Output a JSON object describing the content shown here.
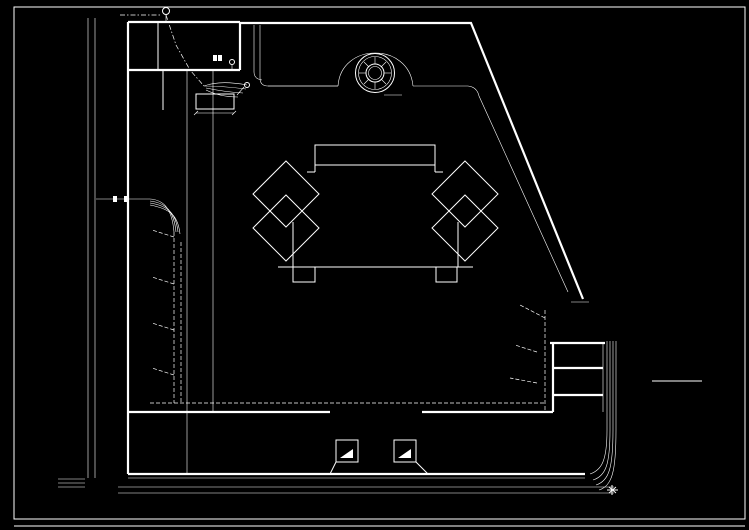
{
  "meta": {
    "bg": "#000000",
    "fg": "#ffffff"
  },
  "labels": {
    "plan_title": "电气总平面图",
    "gate": "大门",
    "fountain": "喷泉",
    "red_line": "红线",
    "top_marker": "T1"
  },
  "legend": {
    "title": "主要电气设备图例表",
    "rows": [
      [
        "单管荧光灯",
        "—⊷",
        "照明配电箱",
        "▭"
      ],
      [
        "双管荧光灯",
        "⊶⊶",
        "动力配电箱",
        "▦"
      ],
      [
        "防水防尘灯",
        "⊗",
        "电度表箱",
        "◫"
      ],
      [
        "吸顶灯",
        "⊕",
        "单相插座",
        "⏚"
      ],
      [
        "壁灯",
        "◑",
        "空调插座",
        "⌇"
      ],
      [
        "疏散指示灯",
        "▣",
        "单联暗开关",
        "↾"
      ],
      [
        "安全出口灯",
        "▤",
        "双联暗开关",
        "⇂"
      ],
      [
        "庭院灯",
        "⍟",
        "电话出线口",
        "TP"
      ],
      [
        "草坪灯",
        "⊙",
        "电视出线口",
        "TV"
      ],
      [
        "路灯",
        "⍉",
        "接地装置",
        "≡"
      ]
    ]
  },
  "title_block": {
    "project": "某住宅小区",
    "scale_label": "比例",
    "scale": "1:500",
    "drawing": "电气总平面图",
    "fields": [
      "设计",
      "制图",
      "校对",
      "审核"
    ],
    "sheet_label": "图别",
    "sheet": "电施",
    "no_label": "图号",
    "no": "01"
  },
  "axes": {
    "left_y": [
      22,
      43,
      65,
      88,
      111,
      133,
      155,
      177,
      201,
      217,
      240,
      264,
      287,
      310,
      332,
      355,
      377,
      400,
      414,
      445,
      473
    ],
    "bottom_x": [
      126,
      150,
      175,
      200,
      225,
      250,
      275,
      300,
      325,
      340,
      357,
      395,
      413,
      428,
      451,
      477,
      503,
      522,
      551,
      578,
      604
    ],
    "left_numbers": [
      "1",
      "2",
      "3",
      "4",
      "5",
      "6",
      "7",
      "8",
      "9",
      "10",
      "11",
      "12",
      "13",
      "14",
      "15",
      "16",
      "17",
      "18",
      "19",
      "20",
      "21"
    ],
    "bottom_numbers": [
      "1",
      "2",
      "3",
      "4",
      "5",
      "6",
      "7",
      "8",
      "9",
      "10",
      "11",
      "12",
      "13",
      "14",
      "15",
      "16",
      "17",
      "18",
      "19",
      "20",
      "21"
    ],
    "dim_left": "3600",
    "dim_bottom": "3300",
    "dim_gap": "7200",
    "dim_pump": "6000"
  },
  "walls": {
    "left_floor_thick": [
      88,
      111,
      133,
      155,
      177,
      201,
      217,
      262,
      310,
      355,
      397
    ],
    "left_floor_thin": [
      240,
      284,
      330,
      375
    ],
    "bottom_wall_x": [
      150,
      175,
      200,
      225,
      250,
      275,
      300,
      325,
      330,
      422,
      428,
      451,
      477,
      503,
      526,
      551,
      583
    ]
  },
  "routes": {
    "junctions": [
      [
        174,
        237
      ],
      [
        181,
        242
      ],
      [
        174,
        284
      ],
      [
        181,
        289
      ],
      [
        174,
        330
      ],
      [
        181,
        335
      ],
      [
        174,
        375
      ],
      [
        181,
        380
      ],
      [
        193,
        403
      ],
      [
        246,
        403
      ],
      [
        298,
        403
      ],
      [
        438,
        403
      ],
      [
        490,
        403
      ],
      [
        543,
        318
      ],
      [
        549,
        325
      ],
      [
        537,
        352
      ],
      [
        543,
        359
      ],
      [
        537,
        383
      ],
      [
        543,
        390
      ],
      [
        205,
        88
      ]
    ],
    "boxes": [
      [
        146,
        404
      ],
      [
        171,
        404
      ],
      [
        196,
        404
      ],
      [
        221,
        404
      ],
      [
        246,
        404
      ],
      [
        271,
        404
      ],
      [
        296,
        404
      ],
      [
        434,
        404
      ],
      [
        459,
        404
      ],
      [
        485,
        404
      ],
      [
        510,
        404
      ],
      [
        535,
        404
      ],
      [
        556,
        344
      ],
      [
        556,
        369
      ],
      [
        556,
        397
      ],
      [
        148,
        246
      ],
      [
        148,
        291
      ],
      [
        148,
        336
      ],
      [
        148,
        381
      ]
    ]
  },
  "rooms": {
    "left_mids": [
      139,
      163,
      188,
      213,
      238,
      263,
      288,
      313
    ],
    "right_mids": [
      440,
      464,
      490,
      515,
      539,
      567
    ],
    "label": "车库"
  },
  "annotations": [
    [
      112,
      12,
      "红线"
    ],
    [
      173,
      12,
      "T1"
    ],
    [
      150,
      42,
      "值班室"
    ],
    [
      204,
      44,
      "门卫"
    ],
    [
      152,
      64,
      "收发"
    ],
    [
      136,
      92,
      "库房"
    ],
    [
      136,
      114,
      "车库"
    ],
    [
      136,
      136,
      "车库"
    ],
    [
      136,
      158,
      "车库"
    ],
    [
      136,
      180,
      "车库"
    ],
    [
      214,
      101,
      "水泵房"
    ],
    [
      215,
      117,
      "6000"
    ],
    [
      98,
      195,
      "进线"
    ],
    [
      98,
      203,
      "YJV-4×50"
    ],
    [
      134,
      191,
      "配电"
    ],
    [
      150,
      230,
      "AL1"
    ],
    [
      150,
      275,
      "AL2"
    ],
    [
      150,
      321,
      "AL3"
    ],
    [
      150,
      366,
      "AL4"
    ],
    [
      191,
      251,
      "N1"
    ],
    [
      191,
      296,
      "N2"
    ],
    [
      191,
      341,
      "N3"
    ],
    [
      191,
      386,
      "N4"
    ],
    [
      222,
      234,
      "BV-3×4"
    ],
    [
      540,
      303,
      "AL5"
    ],
    [
      560,
      338,
      "N5"
    ],
    [
      574,
      356,
      "车库"
    ],
    [
      574,
      383,
      "车库"
    ],
    [
      518,
      391,
      "BV-3×4"
    ],
    [
      558,
      416,
      "N6"
    ],
    [
      243,
      60,
      "路灯"
    ],
    [
      222,
      56,
      "庭院灯"
    ],
    [
      254,
      80,
      "草坪灯"
    ]
  ]
}
